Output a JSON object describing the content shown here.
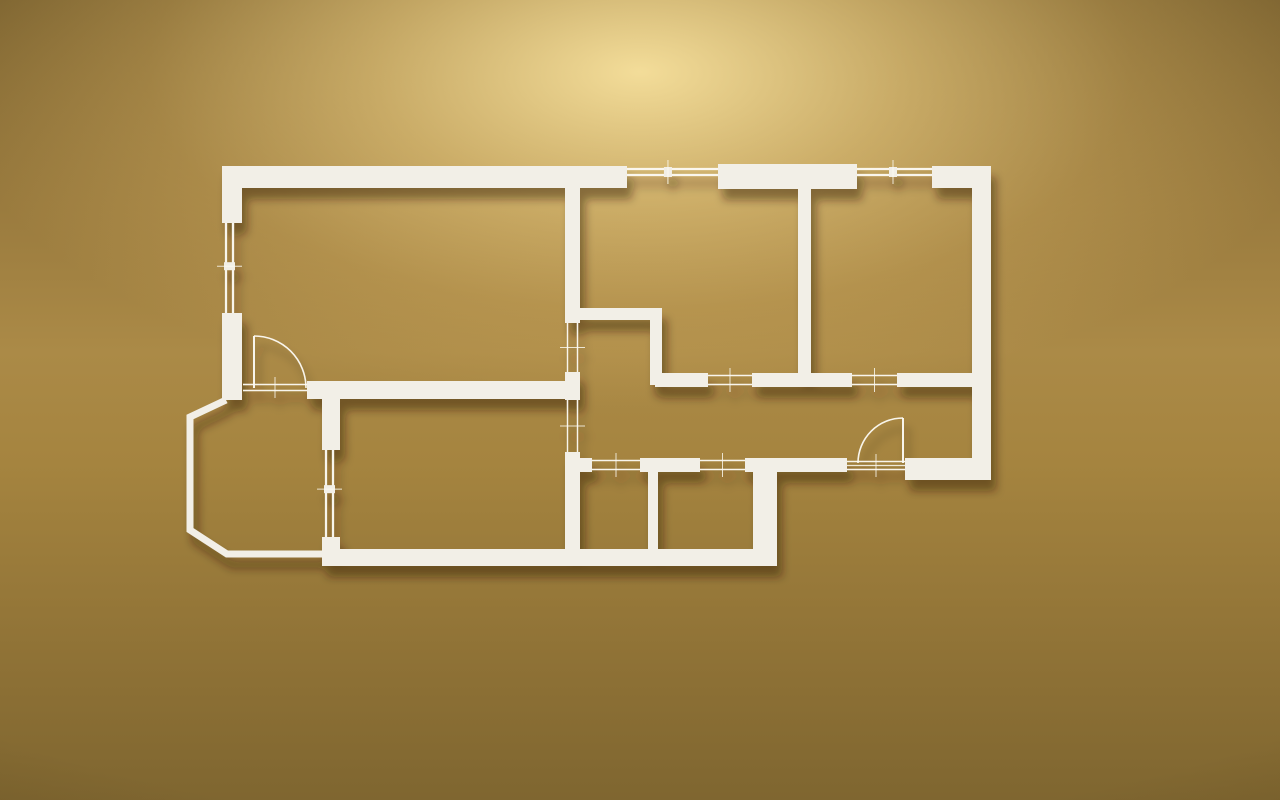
{
  "meta": {
    "type": "3d-floor-plan-render",
    "description": "Miniature white apartment floor-plan model mounted on a warm golden wall, lit softly from the top center, casting shadows down and to the right"
  },
  "palette": {
    "wall_fill": "#f2efe7",
    "wall_bright_line": "#fdfbf4",
    "shadow_color": "#2e1f02",
    "shadow_opacity": 0.45,
    "bg_glow": "#eccd83",
    "bg_mid": "#c7a35a",
    "bg_edge": "#8a6f35",
    "bg_corner": "#6f5a2a"
  },
  "canvas": {
    "width": 1280,
    "height": 800
  },
  "floor_plan": {
    "walls": [
      {
        "id": "outer-top-left",
        "x": 222,
        "y": 166,
        "w": 405,
        "h": 22
      },
      {
        "id": "outer-top-mid",
        "x": 718,
        "y": 164,
        "w": 139,
        "h": 25
      },
      {
        "id": "outer-top-right",
        "x": 932,
        "y": 166,
        "w": 59,
        "h": 22
      },
      {
        "id": "outer-right",
        "x": 972,
        "y": 166,
        "w": 19,
        "h": 314
      },
      {
        "id": "outer-left-upper",
        "x": 222,
        "y": 166,
        "w": 20,
        "h": 57
      },
      {
        "id": "outer-left-lower",
        "x": 222,
        "y": 313,
        "w": 20,
        "h": 87
      },
      {
        "id": "outer-bottom",
        "x": 322,
        "y": 549,
        "w": 455,
        "h": 17
      },
      {
        "id": "entry-corner-block",
        "x": 905,
        "y": 458,
        "w": 86,
        "h": 22
      },
      {
        "id": "balcony-divider-upper",
        "x": 322,
        "y": 399,
        "w": 18,
        "h": 51
      },
      {
        "id": "balcony-divider-lower",
        "x": 322,
        "y": 537,
        "w": 18,
        "h": 14
      },
      {
        "id": "hall-top-wall",
        "x": 307,
        "y": 381,
        "w": 271,
        "h": 18
      },
      {
        "id": "core-vertical-upper",
        "x": 565,
        "y": 188,
        "w": 15,
        "h": 135
      },
      {
        "id": "core-vertical-mid",
        "x": 565,
        "y": 372,
        "w": 15,
        "h": 28
      },
      {
        "id": "core-vertical-lower",
        "x": 565,
        "y": 452,
        "w": 15,
        "h": 103
      },
      {
        "id": "kitchen-nook-top",
        "x": 572,
        "y": 308,
        "w": 90,
        "h": 12
      },
      {
        "id": "kitchen-nook-side",
        "x": 650,
        "y": 308,
        "w": 12,
        "h": 77
      },
      {
        "id": "hall-mid-wall-a",
        "x": 655,
        "y": 373,
        "w": 53,
        "h": 14
      },
      {
        "id": "hall-mid-wall-b",
        "x": 752,
        "y": 373,
        "w": 100,
        "h": 14
      },
      {
        "id": "hall-mid-wall-c",
        "x": 897,
        "y": 373,
        "w": 76,
        "h": 14
      },
      {
        "id": "bedroom-divider",
        "x": 798,
        "y": 188,
        "w": 13,
        "h": 188
      },
      {
        "id": "bath-top-wall-a",
        "x": 565,
        "y": 458,
        "w": 27,
        "h": 14
      },
      {
        "id": "bath-top-wall-b",
        "x": 640,
        "y": 458,
        "w": 60,
        "h": 14
      },
      {
        "id": "bath-top-wall-c",
        "x": 745,
        "y": 458,
        "w": 102,
        "h": 14
      },
      {
        "id": "bath-divider",
        "x": 648,
        "y": 472,
        "w": 10,
        "h": 80
      },
      {
        "id": "bath-right-wall",
        "x": 753,
        "y": 472,
        "w": 24,
        "h": 80
      }
    ],
    "balcony_wall": {
      "id": "balcony-outer-wall",
      "points": "226,400 190,417 190,530 227,554 324,554",
      "thickness": 7
    },
    "windows": [
      {
        "id": "window-top-1",
        "axis": "h",
        "x": 627,
        "y": 166,
        "len": 91,
        "t": 12,
        "post": 0.45
      },
      {
        "id": "window-top-2",
        "axis": "h",
        "x": 857,
        "y": 166,
        "len": 75,
        "t": 12,
        "post": 0.48
      },
      {
        "id": "window-left",
        "axis": "v",
        "x": 223,
        "y": 223,
        "len": 90,
        "t": 13,
        "post": 0.48
      },
      {
        "id": "window-balcony",
        "axis": "v",
        "x": 323,
        "y": 450,
        "len": 87,
        "t": 13,
        "post": 0.45
      }
    ],
    "openings": [
      {
        "id": "opening-core-upper",
        "axis": "v",
        "x": 566,
        "y": 323,
        "len": 49,
        "t": 13
      },
      {
        "id": "opening-core-lower",
        "axis": "v",
        "x": 566,
        "y": 400,
        "len": 52,
        "t": 13
      },
      {
        "id": "opening-room2-door",
        "axis": "h",
        "x": 708,
        "y": 374,
        "len": 44,
        "t": 12
      },
      {
        "id": "opening-room3-door",
        "axis": "h",
        "x": 852,
        "y": 374,
        "len": 45,
        "t": 12
      },
      {
        "id": "opening-bath1-door",
        "axis": "h",
        "x": 592,
        "y": 459,
        "len": 48,
        "t": 12
      },
      {
        "id": "opening-bath2-door",
        "axis": "h",
        "x": 700,
        "y": 459,
        "len": 45,
        "t": 12
      },
      {
        "id": "threshold-balcony-door",
        "axis": "h",
        "x": 243,
        "y": 383,
        "len": 64,
        "t": 9
      },
      {
        "id": "threshold-entry-door",
        "axis": "h",
        "x": 847,
        "y": 460,
        "len": 58,
        "t": 11,
        "triple": true
      }
    ],
    "doors": [
      {
        "id": "balcony-door",
        "leaf": [
          254,
          388,
          254,
          336
        ],
        "arc": "M 254 336 A 52 52 0 0 1 306 388"
      },
      {
        "id": "entry-door",
        "leaf": [
          903,
          463,
          903,
          418
        ],
        "arc": "M 903 418 A 45 45 0 0 0 858 463"
      }
    ]
  }
}
